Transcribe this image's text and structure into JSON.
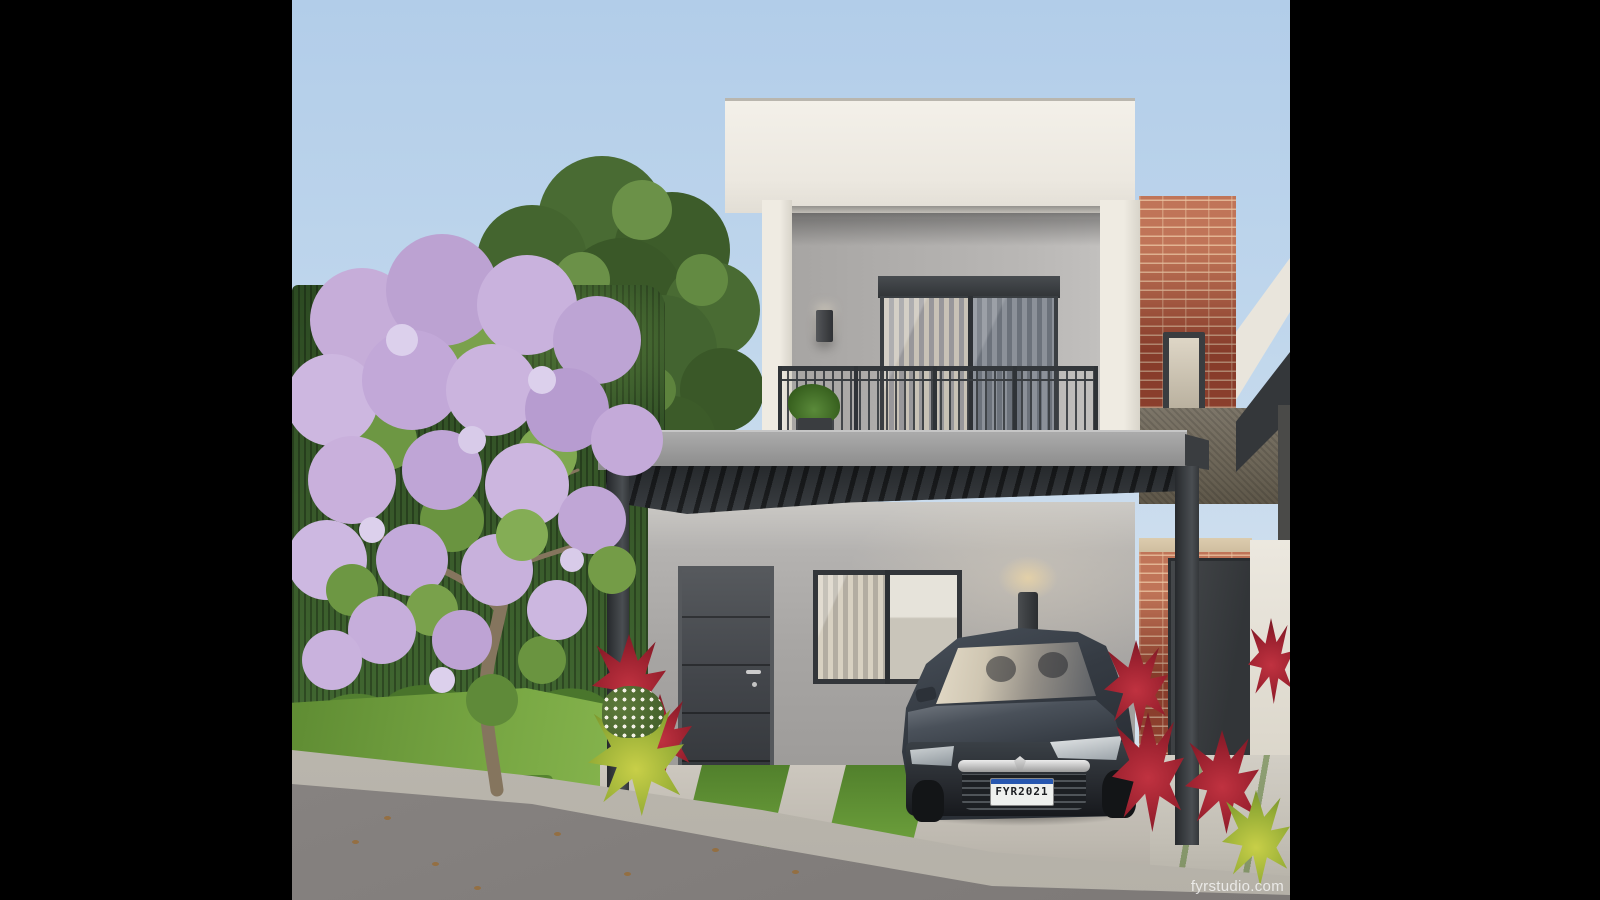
{
  "scene": {
    "description": "3D architectural exterior rendering: modern two-story white and gray house with dark pergola carport, balcony with metal railing, dark gray hatchback parked in driveway, red-brick neighboring townhouse, blooming jacaranda tree, hedge, lawn, sidewalk and street in warm daylight",
    "watermark": {
      "text": "fyrstudio.com"
    },
    "car": {
      "type": "dark gray hatchback",
      "license_plate": {
        "text": "FYR2021"
      }
    },
    "palette": {
      "letterbox": "#000000",
      "sky_top": "#b2cde9",
      "sky_horizon": "#dbe5ec",
      "parapet_white": "#efebe2",
      "upper_wall_gray": "#b3b1af",
      "lower_wall_gray": "#a7a5a3",
      "carport_charcoal": "#33373b",
      "brick_red": "#9e4a36",
      "stone_band": "#6c6557",
      "hedge_green": "#38592a",
      "lawn_green": "#79a844",
      "blossom_lavender": "#c3a9d9",
      "cordyline_red": "#a82836",
      "asphalt_gray": "#8b8785",
      "concrete_light": "#c6c1b8",
      "plate_blue": "#2757b0",
      "sconce_glow": "#f0d9a8"
    }
  }
}
